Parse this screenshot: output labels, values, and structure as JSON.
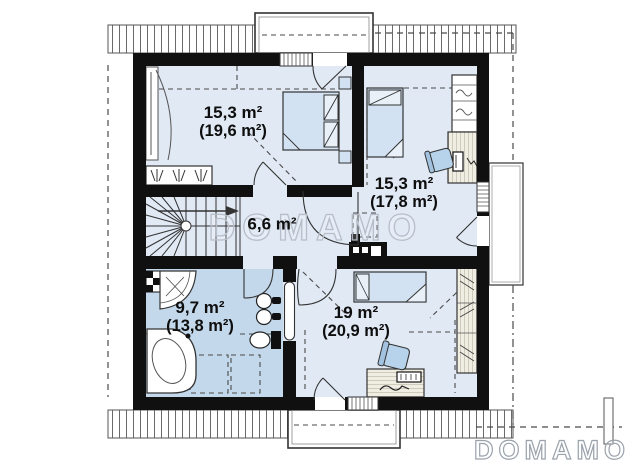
{
  "watermark_text": "DOMAMO",
  "logo_text": "DOMAMO",
  "rooms": [
    {
      "name": "bedroom-1",
      "area": "15,3 m²",
      "area_total": "(19,6 m²)"
    },
    {
      "name": "bedroom-2",
      "area": "15,3 m²",
      "area_total": "(17,8 m²)"
    },
    {
      "name": "hall",
      "area": "6,6 m²",
      "area_total": ""
    },
    {
      "name": "bathroom",
      "area": "9,7 m²",
      "area_total": "(13,8 m²)"
    },
    {
      "name": "bedroom-3",
      "area": "19 m²",
      "area_total": "(20,9 m²)"
    }
  ],
  "colors": {
    "wall": "#101010",
    "floor": "#e1e9f4",
    "bathroom_floor": "#c4d8eb",
    "furniture_blue": "#d2e2f2",
    "accent_blue": "#b7d2eb",
    "wood": "#f0ede3",
    "watermark": "#b7bec9",
    "logo": "#9aa2ac"
  }
}
